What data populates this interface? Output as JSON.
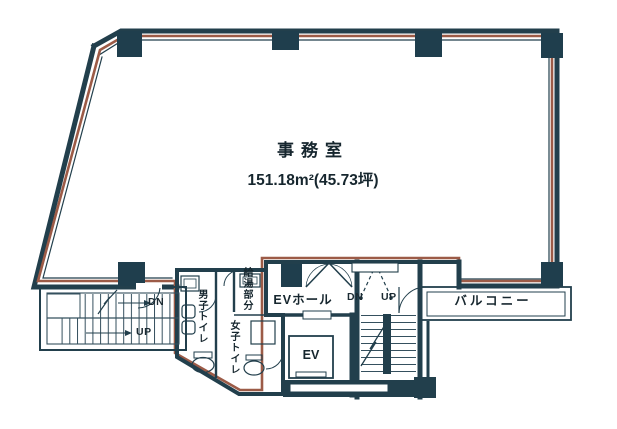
{
  "drawing_title": "office floor plan",
  "colors": {
    "wall": "#223f4c",
    "column": "#1f3e4d",
    "lease_line": "#9c5b47",
    "background": "#ffffff",
    "text": "#16262e"
  },
  "office": {
    "name": "事務室",
    "area": "151.18m²(45.73坪)"
  },
  "core": {
    "ev_hall_label": "EVホール",
    "elevator_label": "EV",
    "balcony_label": "バルコニー",
    "mens_toilet_label": "男子トイレ",
    "womens_toilet_label": "女子トイレ",
    "hot_water_label": "給湯部分"
  },
  "stairs": {
    "left": {
      "down_label": "DN",
      "up_label": "UP"
    },
    "right": {
      "down_label": "DN",
      "up_label": "UP"
    }
  }
}
